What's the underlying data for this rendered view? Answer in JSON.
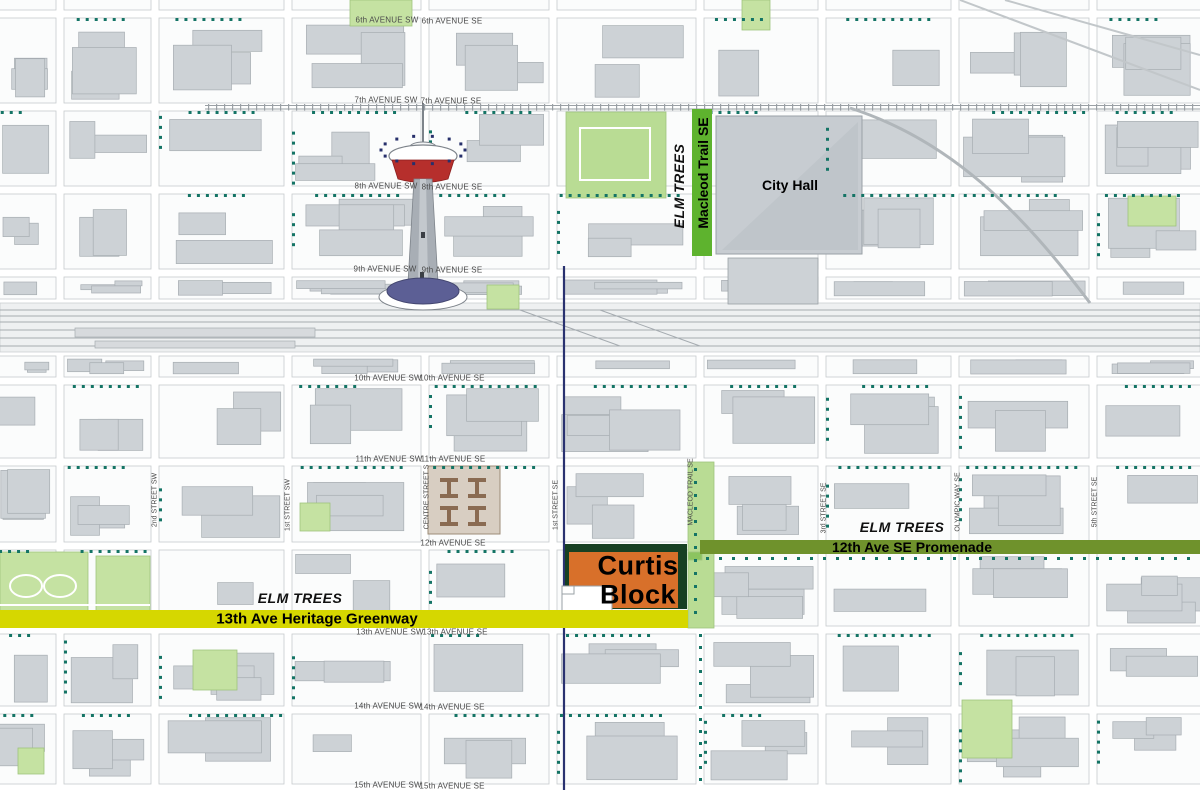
{
  "map": {
    "description": "Downtown Calgary site plan map highlighting Curtis Block",
    "landmarks": {
      "city_hall": "City Hall",
      "curtis_block": {
        "line1": "Curtis",
        "line2": "Block"
      }
    },
    "corridors": {
      "macleod_trail": {
        "elm": "ELM TREES",
        "label": "Macleod Trail SE"
      },
      "promenade": {
        "elm": "ELM TREES",
        "label": "12th Ave SE Promenade"
      },
      "greenway": {
        "elm": "ELM TREES",
        "label": "13th Ave Heritage Greenway"
      }
    },
    "streets": {
      "horizontal": [
        {
          "label": "6th AVENUE SW",
          "x": 387,
          "y": 20
        },
        {
          "label": "6th AVENUE SE",
          "x": 452,
          "y": 21
        },
        {
          "label": "7th AVENUE SW",
          "x": 386,
          "y": 100
        },
        {
          "label": "7th AVENUE SE",
          "x": 451,
          "y": 101
        },
        {
          "label": "8th AVENUE SW",
          "x": 386,
          "y": 186
        },
        {
          "label": "8th AVENUE SE",
          "x": 452,
          "y": 187
        },
        {
          "label": "9th AVENUE SW",
          "x": 385,
          "y": 269
        },
        {
          "label": "9th AVENUE SE",
          "x": 452,
          "y": 270
        },
        {
          "label": "10th AVENUE SW",
          "x": 388,
          "y": 378
        },
        {
          "label": "10th AVENUE SE",
          "x": 452,
          "y": 378
        },
        {
          "label": "11th AVENUE SW",
          "x": 389,
          "y": 459
        },
        {
          "label": "11th AVENUE SE",
          "x": 453,
          "y": 459
        },
        {
          "label": "12th AVENUE SE",
          "x": 453,
          "y": 543
        },
        {
          "label": "13th AVENUE SW",
          "x": 390,
          "y": 632
        },
        {
          "label": "13th AVENUE SE",
          "x": 455,
          "y": 632
        },
        {
          "label": "14th AVENUE SW",
          "x": 388,
          "y": 706
        },
        {
          "label": "14th AVENUE SE",
          "x": 452,
          "y": 707
        },
        {
          "label": "15th AVENUE SW",
          "x": 388,
          "y": 785
        },
        {
          "label": "15th AVENUE SE",
          "x": 452,
          "y": 786
        }
      ],
      "vertical": [
        {
          "label": "2nd STREET SW",
          "x": 155,
          "y": 500
        },
        {
          "label": "1st STREET SW",
          "x": 288,
          "y": 505
        },
        {
          "label": "CENTRE STREET S",
          "x": 427,
          "y": 497
        },
        {
          "label": "1st STREET SE",
          "x": 556,
          "y": 505
        },
        {
          "label": "MACLEOD TRAIL SE",
          "x": 691,
          "y": 492
        },
        {
          "label": "3rd STREET SE",
          "x": 824,
          "y": 508
        },
        {
          "label": "OLYMPIC WAY SE",
          "x": 958,
          "y": 502
        },
        {
          "label": "5th STREET SE",
          "x": 1095,
          "y": 502
        }
      ]
    },
    "colors": {
      "macleod_bar": "#5eb32e",
      "promenade_bar": "#6f922c",
      "greenway_bar": "#d6d700",
      "curtis_fill": "#d8702a",
      "curtis_border": "#174023",
      "park_green": "#c5e2a2",
      "plaza_green": "#b9dc94",
      "tree_dot": "#147465",
      "building_gray": "#cdd2d6",
      "tower_red": "#b62f2c",
      "tower_base_blue": "#5c5f95",
      "transit_blue": "#2a3270"
    }
  }
}
